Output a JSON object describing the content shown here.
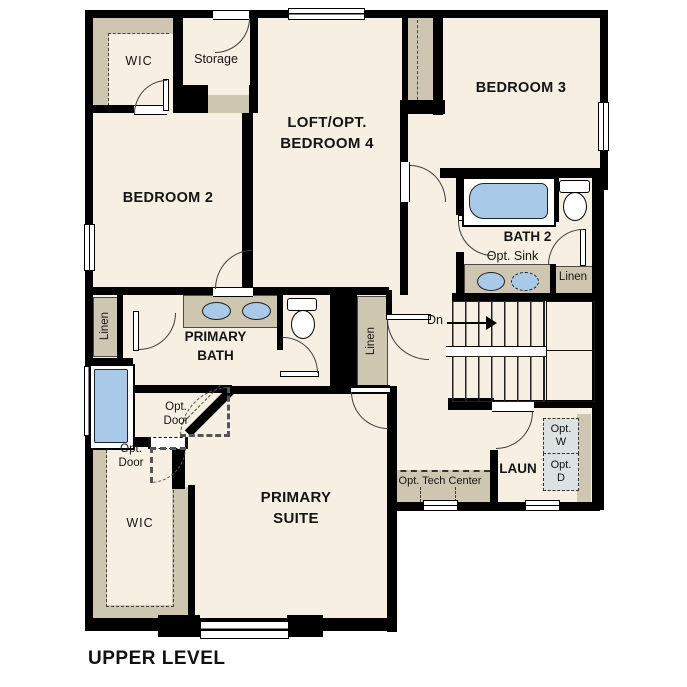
{
  "title": "UPPER LEVEL",
  "colors": {
    "floor": "#f7f0e2",
    "walls": "#000000",
    "casework_tan": "#cfc6b2",
    "fixture_blue": "#a8c9e8",
    "optional_appliance_gray": "#dce1e1"
  },
  "labels": {
    "wic_top": "WIC",
    "storage": "Storage",
    "bedroom2": "BEDROOM 2",
    "loft_l1": "LOFT/OPT.",
    "loft_l2": "BEDROOM 4",
    "bedroom3": "BEDROOM 3",
    "bath2": "BATH 2",
    "opt_sink": "Opt. Sink",
    "linen_bath2": "Linen",
    "dn": "Dn",
    "linen_center": "Linen",
    "primary_bath_l1": "PRIMARY",
    "primary_bath_l2": "BATH",
    "linen_left": "Linen",
    "opt_door_l1": "Opt.",
    "opt_door_l2": "Door",
    "wic_bottom": "WIC",
    "primary_suite_l1": "PRIMARY",
    "primary_suite_l2": "SUITE",
    "laun": "LAUN",
    "opt_tech_center": "Opt. Tech Center",
    "opt_w_l1": "Opt.",
    "opt_w_l2": "W",
    "opt_d_l1": "Opt.",
    "opt_d_l2": "D"
  }
}
